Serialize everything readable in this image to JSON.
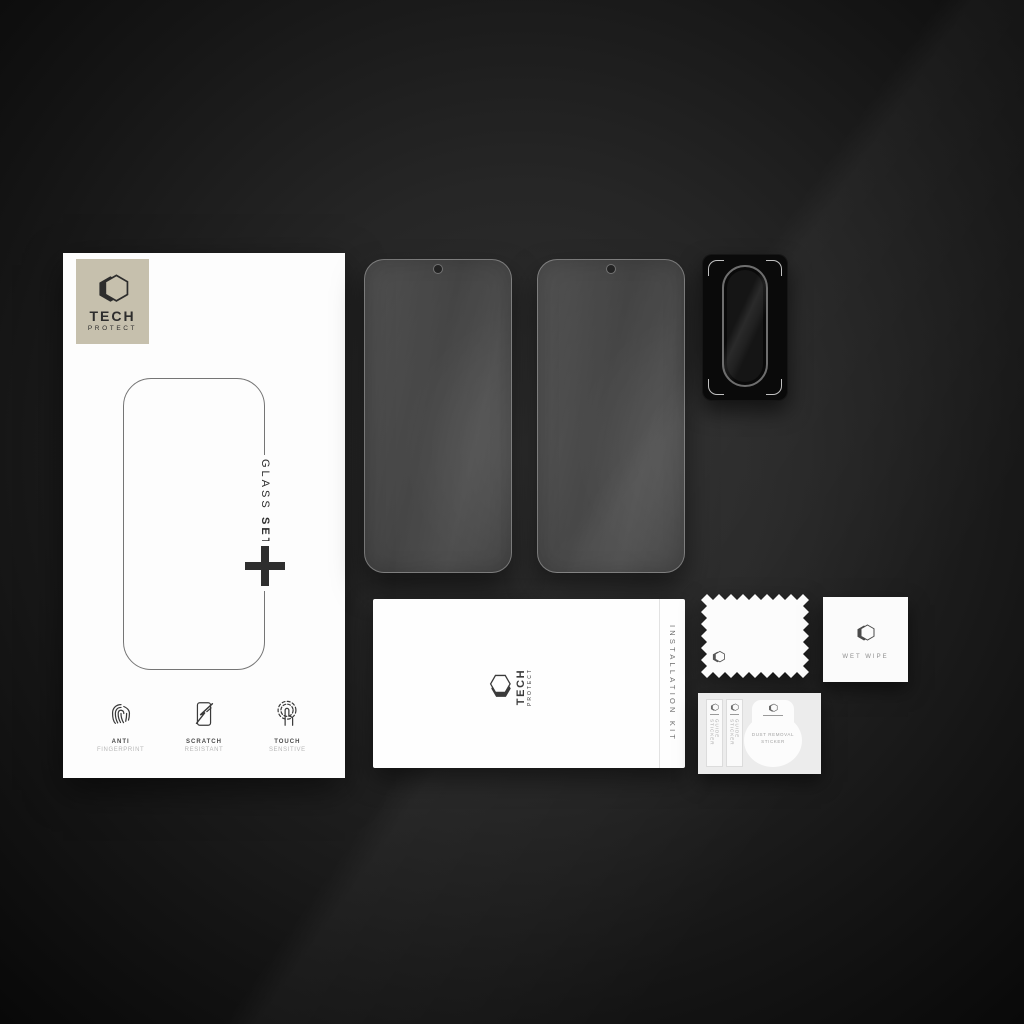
{
  "brand": {
    "name_top": "TECH",
    "name_bottom": "PROTECT"
  },
  "box": {
    "side_label_word1": "GLASS",
    "side_label_word2": "SET",
    "plus_symbol": "+",
    "features": [
      {
        "title": "ANTI",
        "subtitle": "FINGERPRINT",
        "icon": "fingerprint-icon"
      },
      {
        "title": "SCRATCH",
        "subtitle": "RESISTANT",
        "icon": "scratch-resistant-icon"
      },
      {
        "title": "TOUCH",
        "subtitle": "SENSITIVE",
        "icon": "touch-sensitive-icon"
      }
    ]
  },
  "envelope": {
    "label": "INSTALLATION KIT"
  },
  "wet_wipe": {
    "label": "WET WIPE"
  },
  "sticker_card": {
    "guide_sticker_1": "GUIDE STICKER",
    "guide_sticker_2": "GUIDE STICKER",
    "dust_tag_line1": "DUST REMOVAL",
    "dust_tag_line2": "STICKER"
  },
  "icons": {
    "brand_hexagon": "hexagon-logo-icon",
    "plus": "plus-icon",
    "camera_protector": "camera-lens-protector",
    "glass_hole": "punch-hole-camera-cutout"
  },
  "colors": {
    "brand_plate": "#c6c0ad",
    "ink": "#2d2d2d",
    "background_center": "#303030",
    "background_edge": "#080808",
    "box_white": "#fdfdfd",
    "lens_rim": "#6e6e6e"
  }
}
